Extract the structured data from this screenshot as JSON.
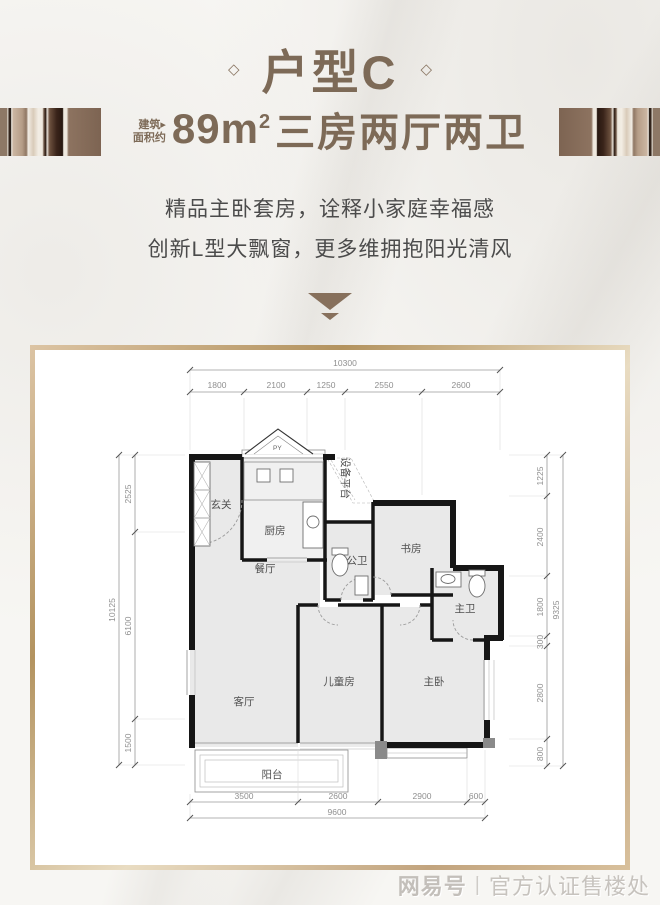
{
  "colors": {
    "brand_brown": "#7d6a57",
    "text_gray": "#4b4b4b",
    "wall_black": "#161616",
    "room_fill": "#e9e9e9",
    "frame_tan": "#c2a47e",
    "watermark_gray": "#c7c3be"
  },
  "header": {
    "title": "户型C",
    "diamond": "◇",
    "area_prefix_line1": "建筑",
    "area_prefix_arrow": "▸",
    "area_prefix_line2": "面积约",
    "area_value": "89m",
    "area_sup": "2",
    "area_rest": "三房两厅两卫",
    "desc_line1": "精品主卧套房，诠释小家庭幸福感",
    "desc_line2": "创新L型大飘窗，更多维拥抱阳光清风"
  },
  "plan": {
    "rooms": {
      "entry": "玄关",
      "kitchen": "厨房",
      "equipment": "设备平台",
      "dining": "餐厅",
      "public_bath": "公卫",
      "study": "书房",
      "master_bath": "主卫",
      "living": "客厅",
      "children": "儿童房",
      "master_bed": "主卧",
      "balcony": "阳台"
    },
    "flue_label": "PY",
    "dims": {
      "top_total": "10300",
      "top_segments": [
        "1800",
        "2100",
        "1250",
        "2550",
        "2600"
      ],
      "bottom_segments": [
        "3500",
        "2600",
        "2900",
        "600"
      ],
      "bottom_total": "9600",
      "left_total": "10125",
      "left_segments": [
        "2525",
        "6100",
        "1500"
      ],
      "right_total": "9325",
      "right_segments": [
        "1225",
        "2400",
        "1800",
        "300",
        "2800",
        "800"
      ]
    }
  },
  "footer": {
    "watermark_logo": "网易号",
    "watermark_divider": "|",
    "watermark_text": "官方认证售楼处"
  }
}
